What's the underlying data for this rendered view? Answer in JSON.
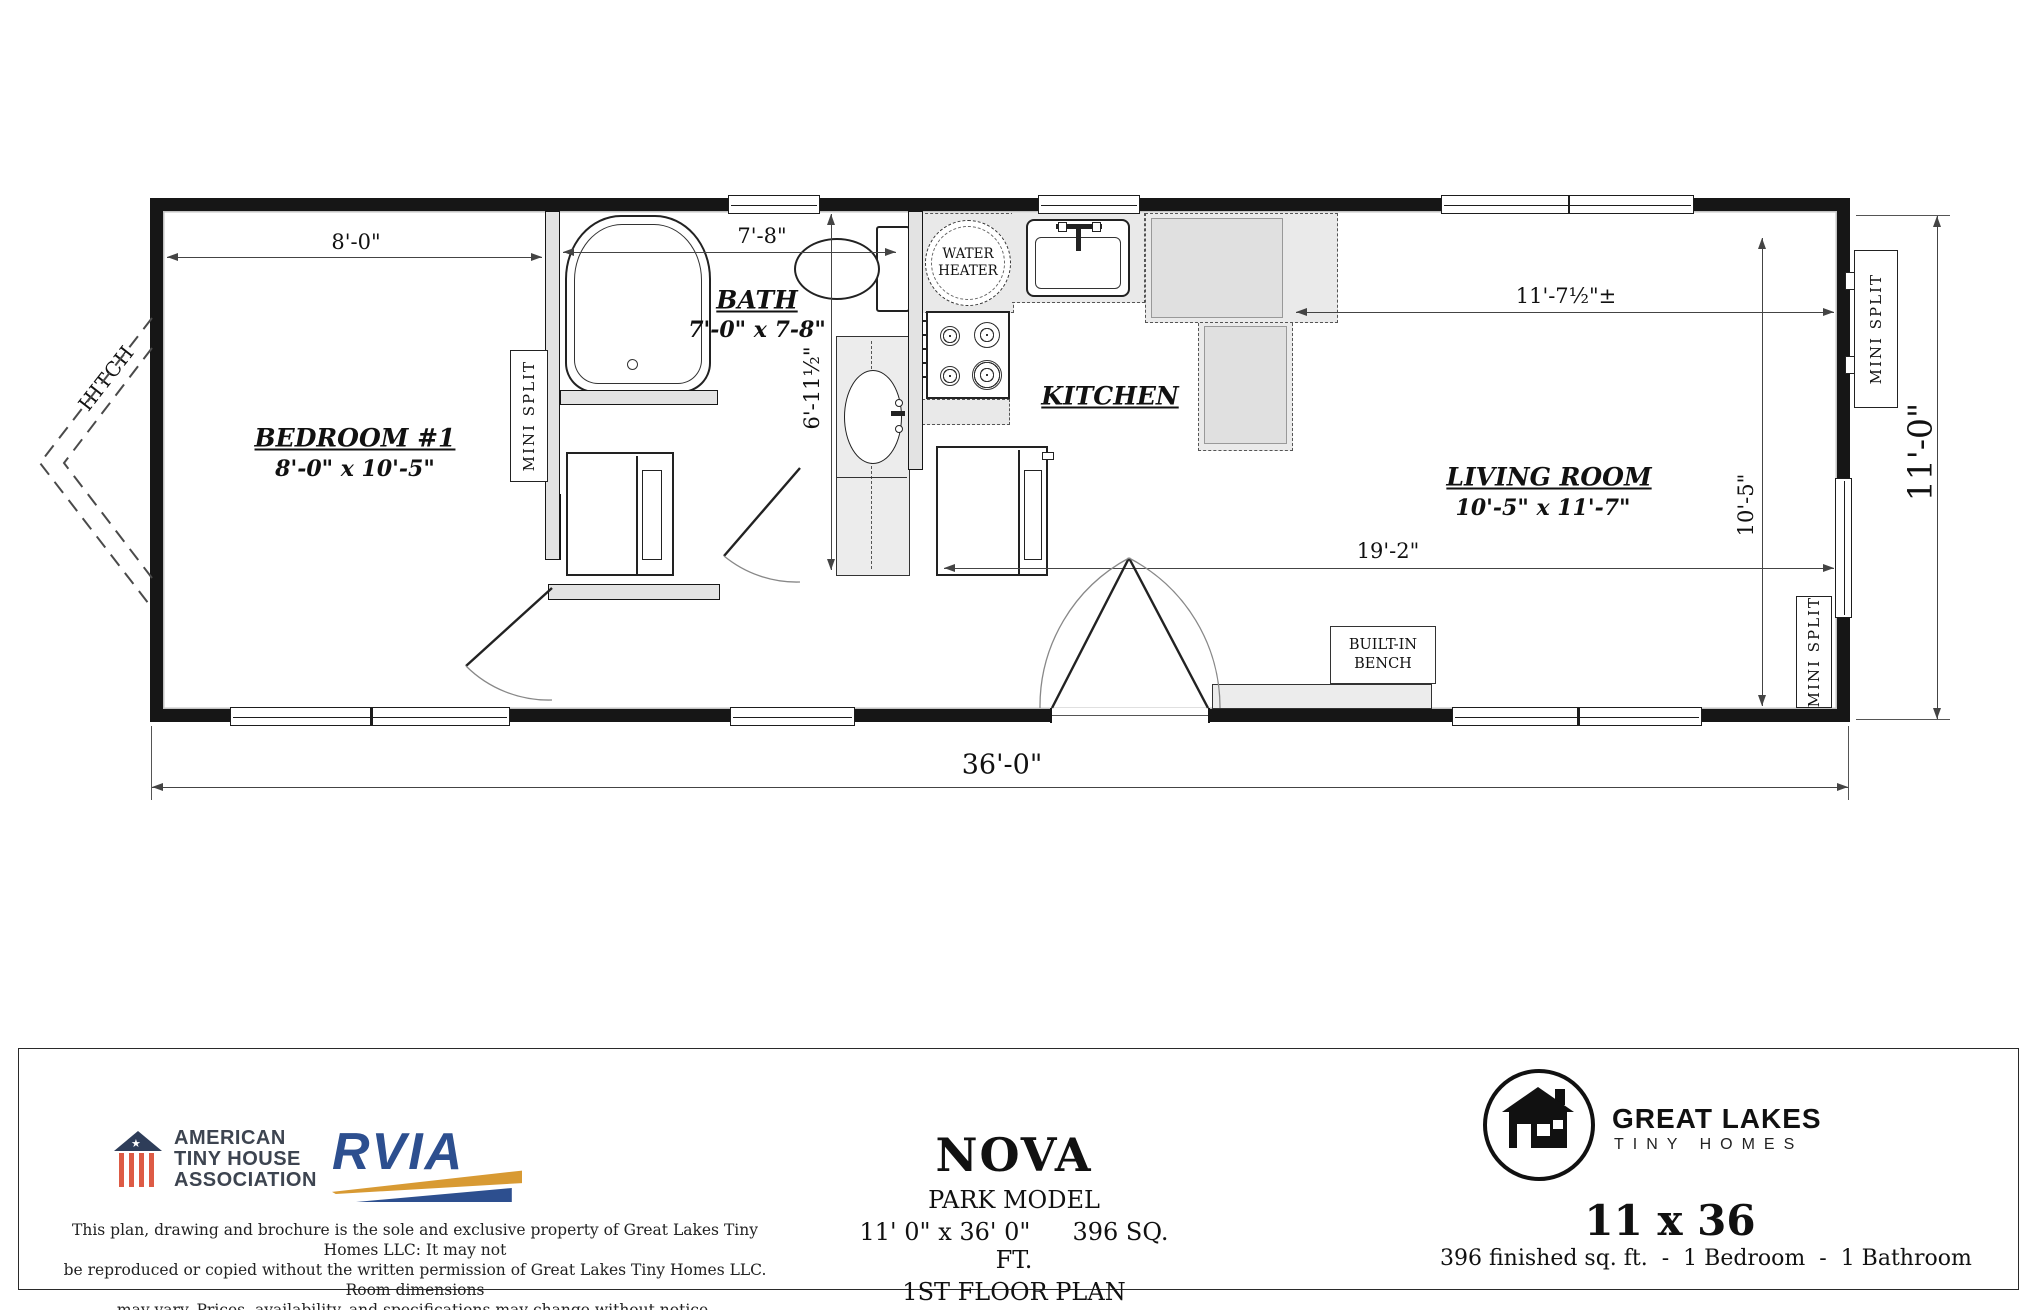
{
  "plan": {
    "hitch_label": "HITCH",
    "rooms": {
      "bedroom": {
        "name": "BEDROOM #1",
        "dims": "8'-0\" x 10'-5\""
      },
      "bath": {
        "name": "BATH",
        "dims": "7'-0\" x 7-8\""
      },
      "kitchen": {
        "name": "KITCHEN"
      },
      "living": {
        "name": "LIVING ROOM",
        "dims": "10'-5\" x 11'-7\""
      }
    },
    "fixtures": {
      "water_heater": "WATER HEATER",
      "mini_split": "MINI SPLIT",
      "bench_line1": "BUILT-IN",
      "bench_line2": "BENCH"
    },
    "dimensions": {
      "bedroom_width": "8'-0\"",
      "bath_width": "7'-8\"",
      "bath_depth": "6'-11½\"",
      "living_width": "11'-7½\"±",
      "living_depth": "10'-5\"",
      "living_run": "19'-2\"",
      "overall_width": "36'-0\"",
      "overall_height": "11'-0\""
    }
  },
  "footer": {
    "atha": {
      "line1": "AMERICAN",
      "line2": "TINY HOUSE",
      "line3": "ASSOCIATION"
    },
    "rvia": {
      "name": "RVIA"
    },
    "copyright": {
      "line1": "This plan, drawing and brochure is the sole and exclusive property of Great Lakes Tiny Homes LLC: It may not",
      "line2": "be reproduced or copied without the written permission of Great Lakes Tiny Homes LLC. Room dimensions",
      "line3": "may vary. Prices, availability, and specifications may change without notice."
    },
    "title": {
      "name": "NOVA",
      "subtitle": "PARK MODEL",
      "dims": "11' 0\" x 36' 0\"",
      "sqft": "396 SQ. FT.",
      "floor": "1ST FLOOR PLAN"
    },
    "brand": {
      "line1": "GREAT LAKES",
      "line2": "TINY HOMES",
      "model": "11 x 36",
      "specs": "396 finished sq. ft.  -  1 Bedroom  -  1 Bathroom"
    }
  },
  "colors": {
    "line": "#161616",
    "accent_navy": "#2d4f8f",
    "accent_gold": "#d89a33",
    "atha_red": "#dd5b45",
    "atha_navy": "#2e3d59"
  }
}
